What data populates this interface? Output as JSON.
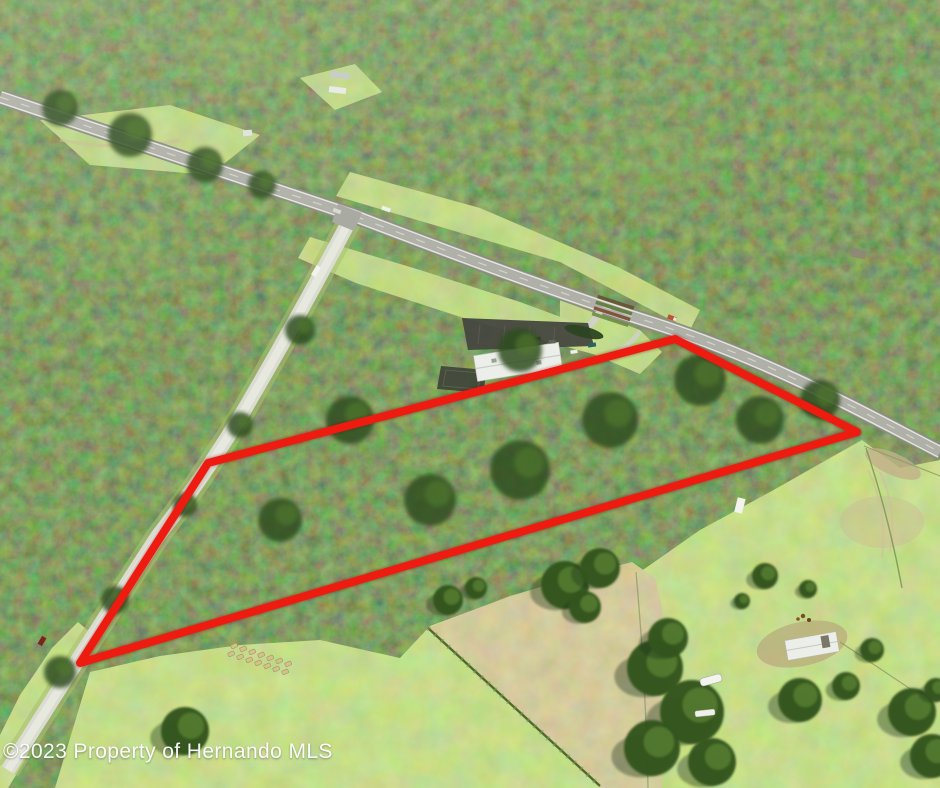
{
  "image": {
    "subject": "aerial-photo-wooded-land-parcel",
    "watermark": "©2023 Property of Hernando MLS"
  },
  "boundary": {
    "points": "208,463 675,339 857,432 80,663",
    "color": "#ee1b10",
    "stroke_width": 8
  },
  "palette": {
    "boundary_red": "#ee1b10",
    "forest_dark": "#2c4720",
    "forest_light": "#6f9440",
    "pasture_green": "#9cc25c",
    "dry_field": "#b3a878",
    "road_concrete": "#dadcd2",
    "highway_asphalt": "#a7a8a0",
    "building_roof": "#eceee9",
    "parking_asphalt": "#46473f",
    "hay": "#d2c289"
  },
  "scene": {
    "field_trees": [
      [
        565,
        585,
        24
      ],
      [
        600,
        568,
        20
      ],
      [
        585,
        607,
        16
      ],
      [
        655,
        668,
        28
      ],
      [
        692,
        712,
        32
      ],
      [
        652,
        748,
        28
      ],
      [
        712,
        762,
        24
      ],
      [
        668,
        638,
        20
      ],
      [
        448,
        600,
        15
      ],
      [
        476,
        588,
        11
      ],
      [
        765,
        576,
        13
      ],
      [
        808,
        589,
        9
      ],
      [
        742,
        601,
        8
      ],
      [
        800,
        700,
        22
      ],
      [
        846,
        686,
        14
      ],
      [
        872,
        650,
        12
      ],
      [
        912,
        712,
        24
      ],
      [
        932,
        756,
        22
      ],
      [
        936,
        690,
        12
      ],
      [
        185,
        731,
        24
      ]
    ],
    "canopy_clumps": [
      [
        60,
        108,
        18
      ],
      [
        130,
        135,
        22
      ],
      [
        205,
        165,
        18
      ],
      [
        262,
        185,
        14
      ],
      [
        300,
        330,
        15
      ],
      [
        240,
        425,
        13
      ],
      [
        185,
        505,
        12
      ],
      [
        115,
        600,
        14
      ],
      [
        60,
        672,
        16
      ],
      [
        520,
        470,
        30
      ],
      [
        430,
        500,
        26
      ],
      [
        610,
        420,
        28
      ],
      [
        700,
        380,
        26
      ],
      [
        350,
        420,
        24
      ],
      [
        280,
        520,
        22
      ],
      [
        520,
        350,
        22
      ],
      [
        760,
        420,
        24
      ],
      [
        820,
        400,
        20
      ]
    ],
    "hay_bales": [
      [
        234,
        646
      ],
      [
        243,
        649
      ],
      [
        252,
        652
      ],
      [
        261,
        655
      ],
      [
        270,
        658
      ],
      [
        279,
        661
      ],
      [
        288,
        664
      ],
      [
        231,
        654
      ],
      [
        240,
        657
      ],
      [
        249,
        660
      ],
      [
        258,
        663
      ],
      [
        267,
        666
      ],
      [
        276,
        669
      ],
      [
        285,
        672
      ]
    ]
  }
}
